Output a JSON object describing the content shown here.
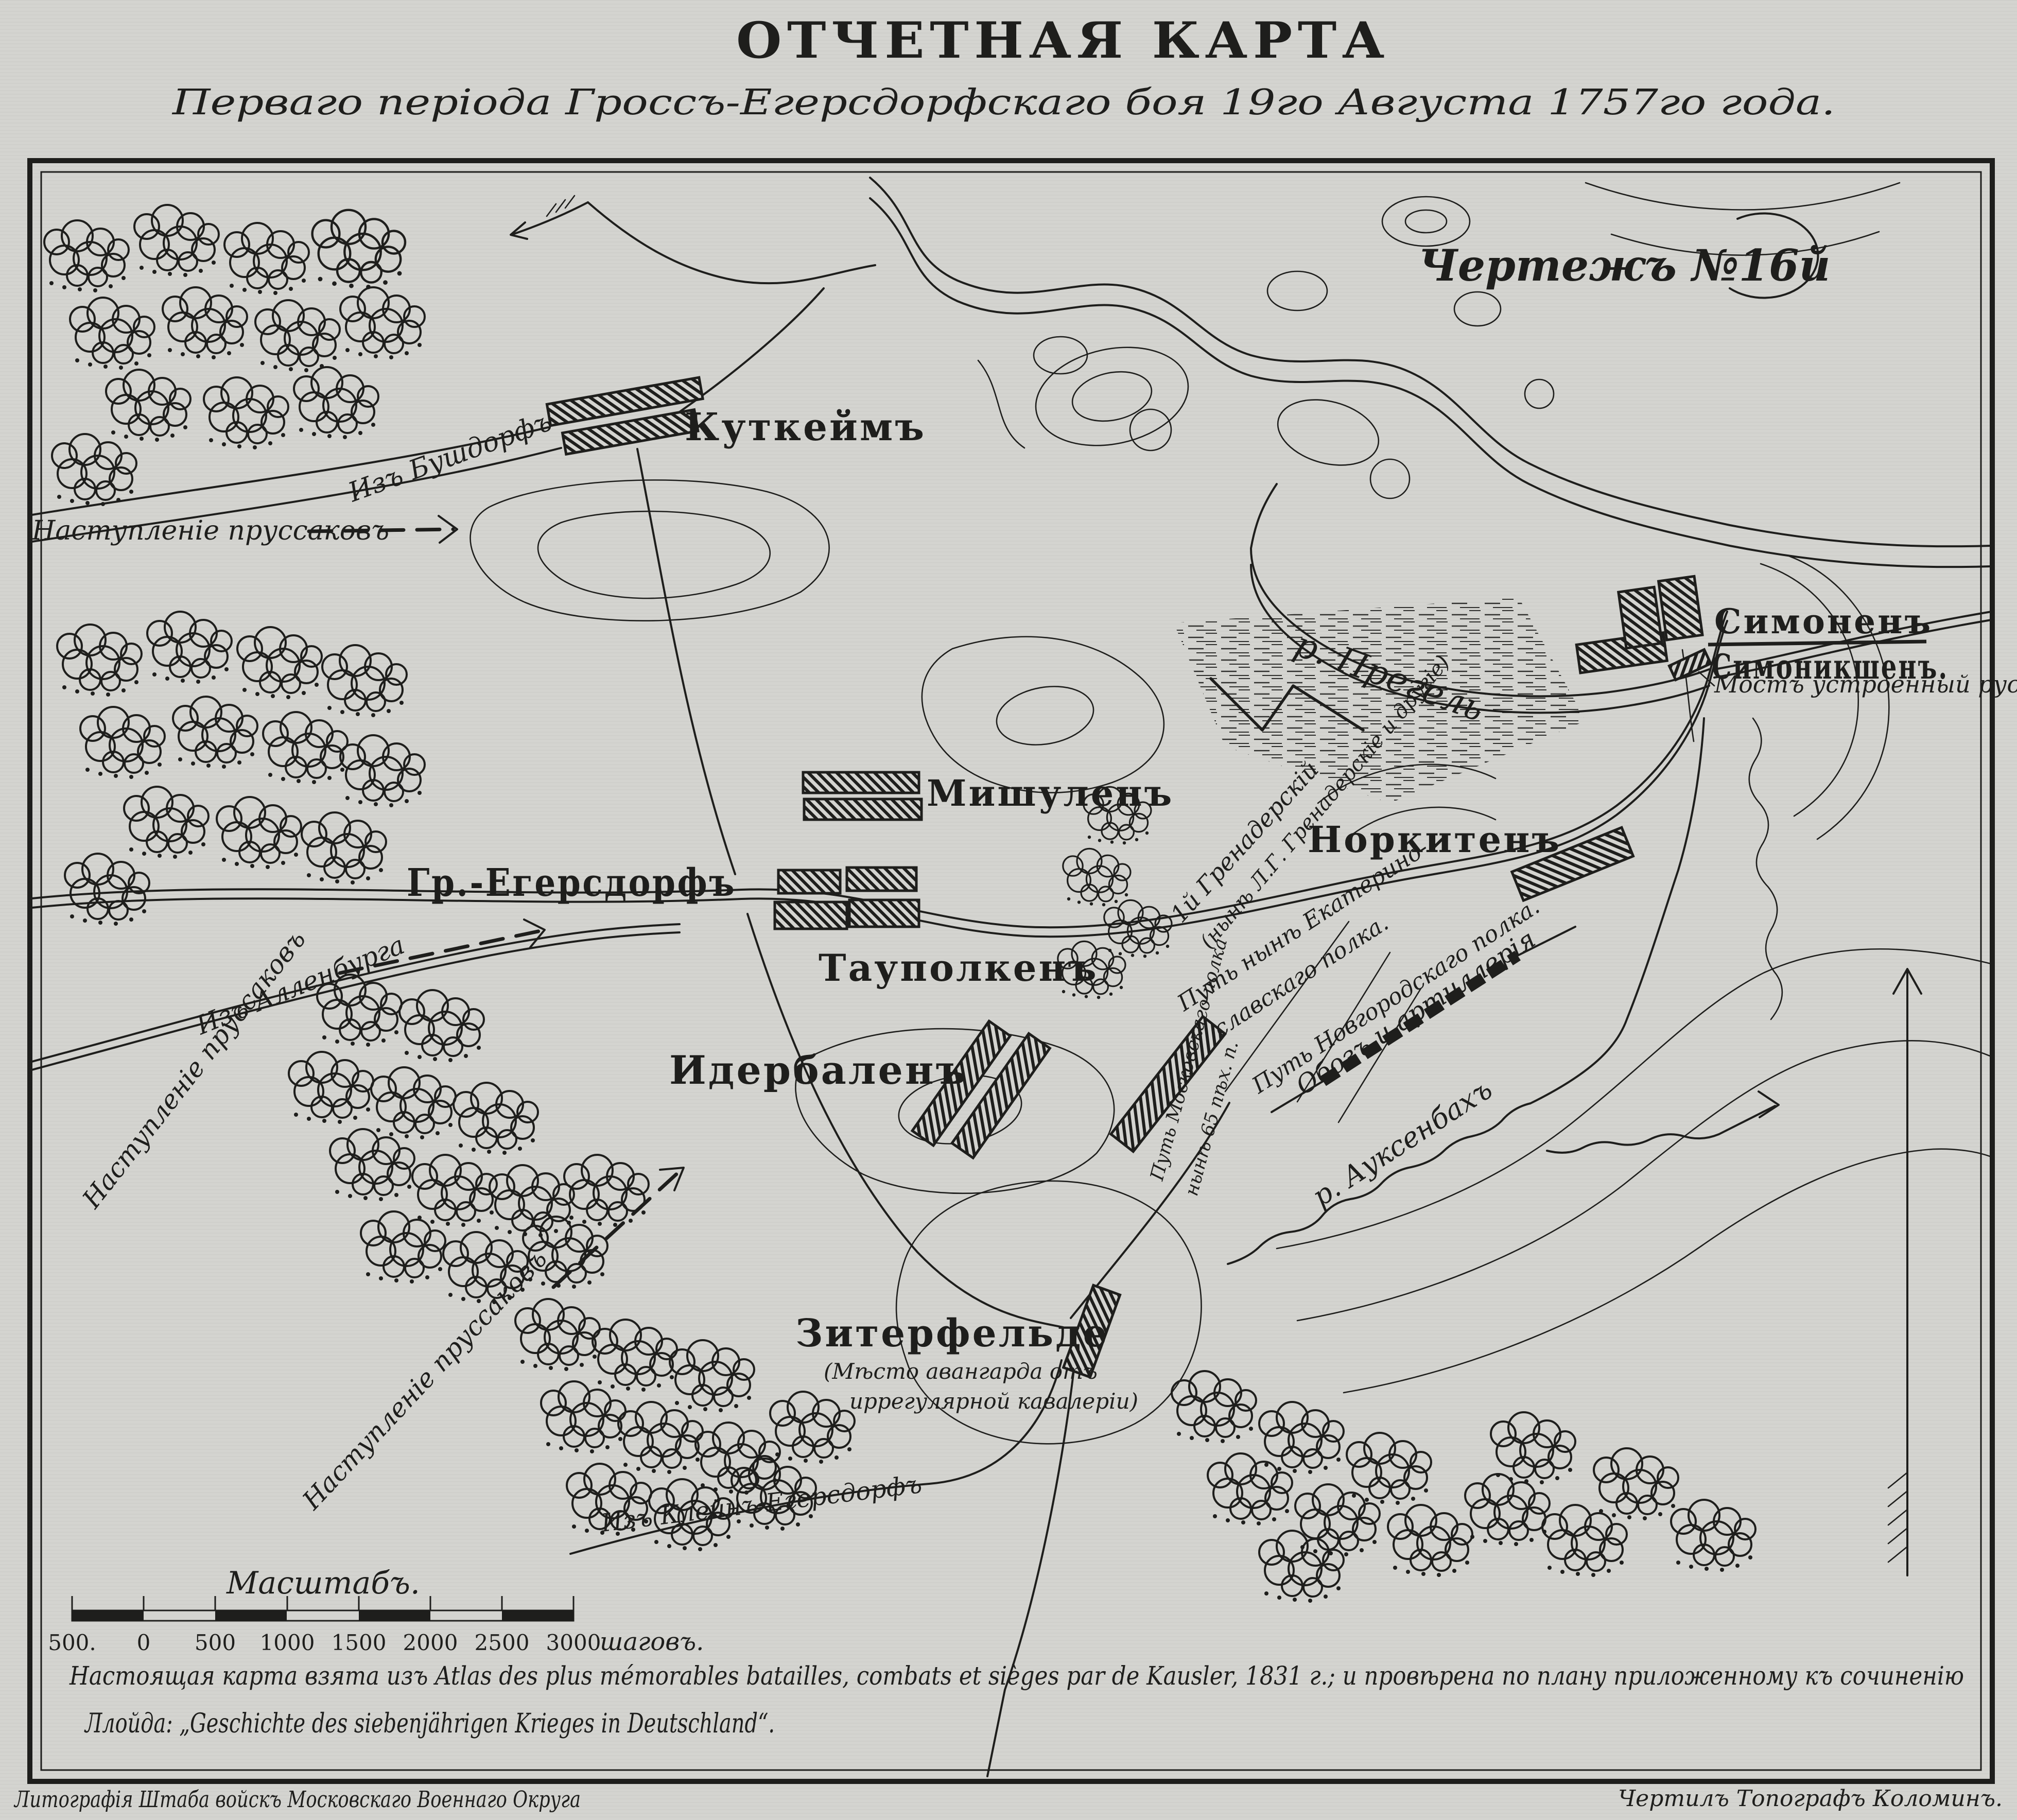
{
  "header": {
    "title": "ОТЧЕТНАЯ КАРТА",
    "subtitle": "Перваго періода Гроссъ-Егерсдорфскаго боя 19го Августа 1757го года.",
    "drawing_no": "Чертежъ №16й"
  },
  "settlements": {
    "kutkeim": "Куткеймъ",
    "mishulen": "Мишуленъ",
    "gross_egersdorf": "Гр.-Егерсдорфъ",
    "taupolken": "Тауполкенъ",
    "iderbalen": "Идербаленъ",
    "norkiten": "Норкитенъ",
    "simonen": "Симоненъ",
    "simonikshen": "Симоникшенъ.",
    "siterfelde": "Зитерфельде",
    "siterfelde_note1": "(Мѣсто авангарда отъ",
    "siterfelde_note2": "иррегулярной кавалеріи)"
  },
  "routes": {
    "iz_bushdorf": "Изъ Бушдорфъ",
    "iz_allenburga": "Изъ Алленбурга",
    "iz_klein_egersdorf": "Изъ Клейнъ-Егерсдорфъ",
    "prussian_advance": "Наступленіе пруссаковъ",
    "grenadier_path": "1й Гренадерскій",
    "grenadier_note": "(нынѣ Л.Г. Гренадерскіе и другіе)",
    "ekaterinoslav_1": "Путь нынѣ Екатерино-",
    "ekaterinoslav_2": "славскаго полка.",
    "novgorod_path": "Путь Новгородскаго полка.",
    "moscow_path": "Путь Московскаго полка",
    "moscow_note": "нынѣ 65 пѣх. п.",
    "oboz": "Обозъ и артиллерія"
  },
  "waters": {
    "pregel": "р. Прегель",
    "auksenbach": "р. Ауксенбахъ",
    "bridge_note": "Мостъ устроенный русскими"
  },
  "scale": {
    "caption": "Масштабъ.",
    "ticks": [
      "500.",
      "0",
      "500",
      "1000",
      "1500",
      "2000",
      "2500",
      "3000"
    ],
    "unit": "шаговъ."
  },
  "footer": {
    "source_line1": "Настоящая карта взята изъ Atlas des plus mémorables batailles, combats et sièges par de Kausler, 1831 г.; и провѣрена по плану приложенному къ сочиненію",
    "source_line2": "Ллойда: „Geschichte des siebenjährigen Krieges in Deutschland“.",
    "credit_left": "Литографія Штаба войскъ Московскаго Военнаго Округа",
    "credit_right": "Чертилъ Топографъ Коломинъ."
  },
  "colors": {
    "paper": "#d4d4d0",
    "ink": "#1e1e1c"
  }
}
